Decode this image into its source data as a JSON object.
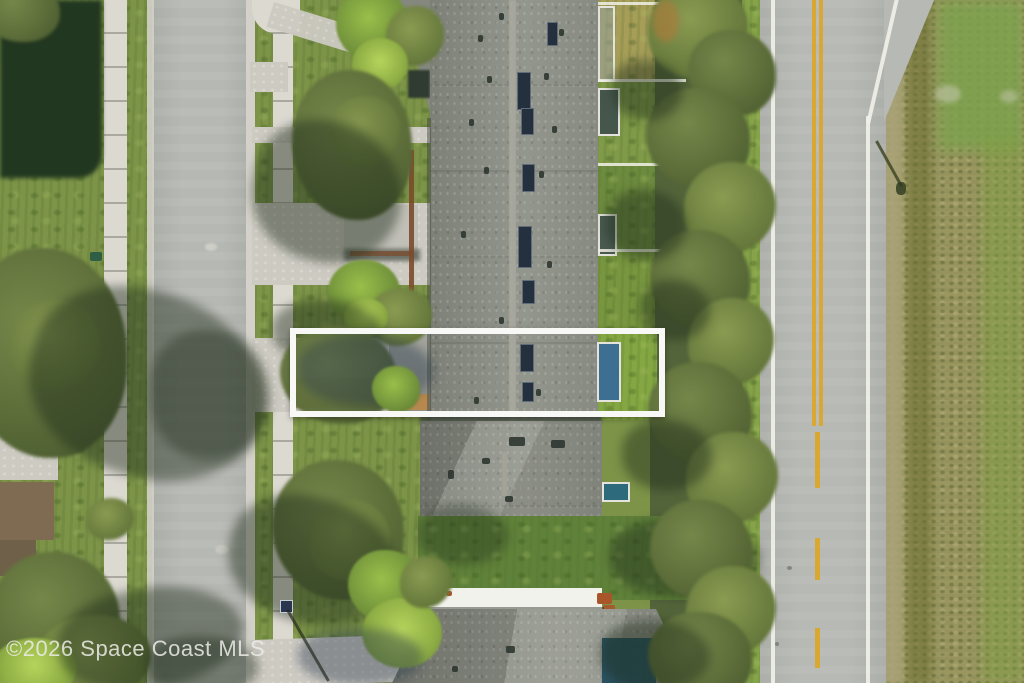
{
  "watermark": {
    "text": "©2026 Space Coast MLS"
  },
  "annotation": {
    "shape": "rectangle-outline",
    "purpose": "highlighted-unit-boundary",
    "color": "#f8f8f6"
  },
  "colors": {
    "grass": "#7c9348",
    "field": "#9a9660",
    "roof_shingle": "#8d9086",
    "street": "#b7b9b4",
    "sidewalk": "#dcd9d1",
    "driveway": "#cdcac2",
    "road_line_white": "#f0f0e8",
    "road_line_yellow": "#d9a832",
    "skylight": "#24303e",
    "tree_dark": "#53643a",
    "tree_bright": "#9abf4a",
    "lanai_blue": "#3c6f92",
    "pool_teal": "#1d4a5c"
  }
}
